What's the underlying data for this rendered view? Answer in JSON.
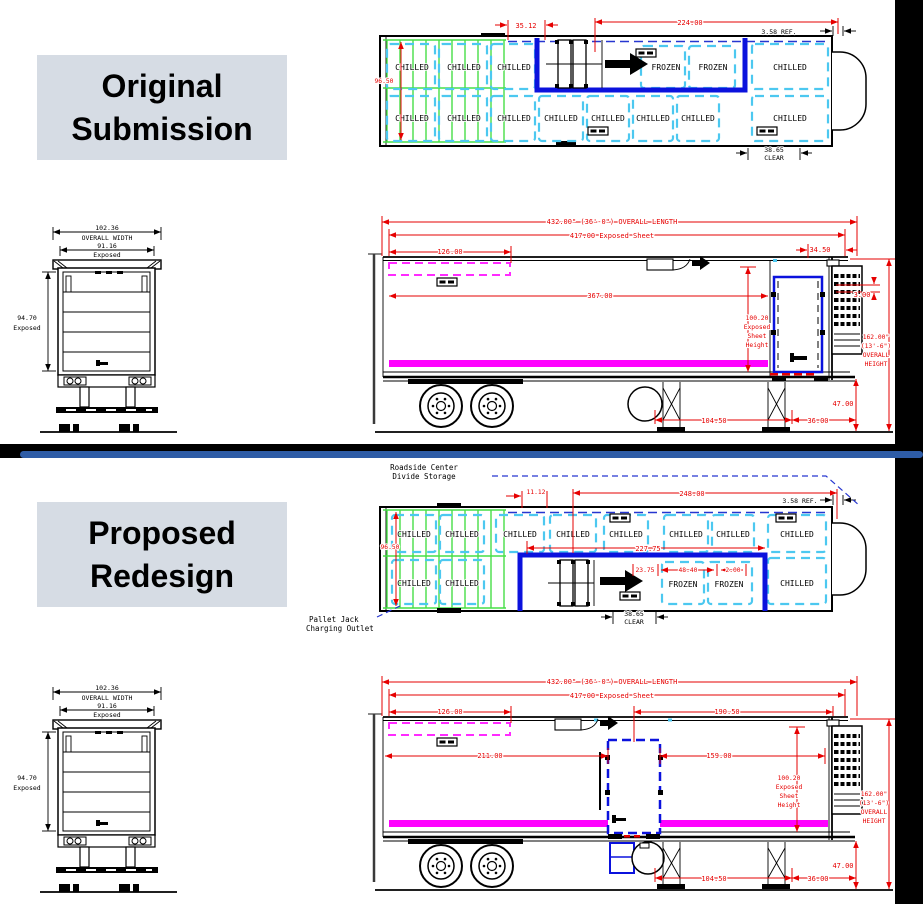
{
  "colors": {
    "dim_red": "#e60000",
    "pallet_cyan": "#4cc8f0",
    "divide_navy": "#2636d0",
    "etrack_green": "#46df46",
    "frozen_blue": "#0b12dd",
    "floor_magenta": "#ff00ff",
    "title_bg": "#d6dce4",
    "divider_blue": "#2e5ca6",
    "frame_black": "#000000"
  },
  "rear": {
    "w": "102.36",
    "w_lbl": "OVERALL WIDTH",
    "e": "91.16",
    "e_lbl": "Exposed",
    "h": "94.70",
    "h_lbl": "Exposed"
  },
  "orig": {
    "title_line1": "Original",
    "title_line2": "Submission",
    "plan": {
      "d3512": "35.12",
      "d224": "224.00",
      "ref": "3.58 REF.",
      "d9650": "96.50",
      "clear_val": "38.65",
      "clear_lbl": "CLEAR",
      "top_labels": [
        "CHILLED",
        "CHILLED",
        "CHILLED"
      ],
      "frozen_labels": [
        "FROZEN",
        "FROZEN"
      ],
      "top_right_label": "CHILLED",
      "bottom_labels": [
        "CHILLED",
        "CHILLED",
        "CHILLED",
        "CHILLED",
        "CHILLED",
        "CHILLED",
        "CHILLED",
        "CHILLED"
      ]
    },
    "side": {
      "len": "432.00\" (36'-0\") OVERALL LENGTH",
      "sheet": "417.00 Exposed Sheet",
      "d126": "126.00",
      "d367": "367.00",
      "d3450": "34.50",
      "d300": "3.00",
      "sheet_h": [
        "100.20",
        "Exposed",
        "Sheet",
        "Height"
      ],
      "overall_h": [
        "162.00\"",
        "(13'-6\")",
        "OVERALL",
        "HEIGHT"
      ],
      "d47": "47.00",
      "d10450": "104.50",
      "d36": "36.00"
    }
  },
  "prop": {
    "title_line1": "Proposed",
    "title_line2": "Redesign",
    "ann": {
      "roadside1": "Roadside Center",
      "roadside2": "Divide Storage",
      "pallet1": "Pallet Jack",
      "pallet2": "Charging Outlet"
    },
    "plan": {
      "d1112": "11.12",
      "d248": "248.00",
      "ref": "3.58 REF.",
      "d9650": "96.50",
      "d22775": "227.75",
      "d2375": "23.75",
      "d4840": "48.40",
      "d200": "2.00",
      "clear_val": "38.65",
      "clear_lbl": "CLEAR",
      "top_labels": [
        "CHILLED",
        "CHILLED",
        "CHILLED",
        "CHILLED",
        "CHILLED",
        "CHILLED",
        "CHILLED",
        "CHILLED"
      ],
      "bottom_left_labels": [
        "CHILLED",
        "CHILLED"
      ],
      "frozen_labels": [
        "FROZEN",
        "FROZEN"
      ],
      "bottom_right_label": "CHILLED"
    },
    "side": {
      "len": "432.00\" (36'-0\") OVERALL LENGTH",
      "sheet": "417.00 Exposed Sheet",
      "d126": "126.00",
      "d19050": "190.50",
      "d211": "211.00",
      "d159": "159.00",
      "sheet_h": [
        "100.20",
        "Exposed",
        "Sheet",
        "Height"
      ],
      "overall_h": [
        "162.00\"",
        "(13'-6\")",
        "OVERALL",
        "HEIGHT"
      ],
      "d47": "47.00",
      "d10450": "104.50",
      "d36": "36.00"
    }
  }
}
